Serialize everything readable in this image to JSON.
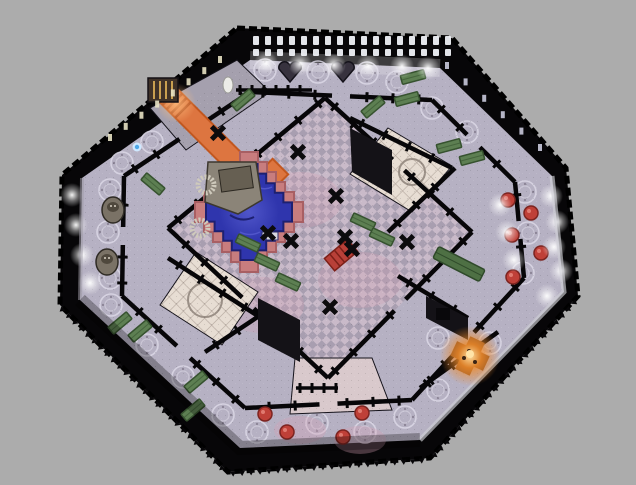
{
  "scene": {
    "viewport": {
      "width": 636,
      "height": 485
    },
    "background": "#acacac",
    "colors": {
      "wall": "#070608",
      "corridor_floor": "#b6b1c3",
      "hall_tile_light": "#c9bac9",
      "hall_tile_dark": "#a89eb0",
      "room_tile_light": "#e7ddd3",
      "room_tile_line": "#b4a79e",
      "pool_blue": "#2f35ad",
      "pool_blue_dark": "#1d2070",
      "pool_ripple_light": "#575dd0",
      "pool_pink": "#c87d7e",
      "pool_pink_dark": "#a85f63",
      "carpet_orange": "#dd7540",
      "carpet_orange_dark": "#b04818",
      "carpet_glow": "#f09a50",
      "bench_green": "#5d7f52",
      "bench_green_dark": "#36522f",
      "table_red": "#bf4038",
      "table_red_dark": "#7c2420",
      "window_white": "#eef0f6",
      "window_yellow": "#e8e2c4",
      "window_dim": "#c9c9dc",
      "fire_glow": "#f08a28",
      "fire_core": "#ffe4a8",
      "stone": "#8b8478",
      "stone_dark": "#665f52",
      "statue": "#7a7266",
      "statue_dark": "#37323e",
      "rim_light": "#d0cfd6",
      "flower_line": "#dcd8e6",
      "altar_wood": "#3f3228",
      "altar_gold": "#c9a050",
      "rug_red": "#b84038"
    },
    "outer_octagon": [
      [
        237,
        28
      ],
      [
        452,
        38
      ],
      [
        566,
        168
      ],
      [
        578,
        296
      ],
      [
        430,
        458
      ],
      [
        228,
        472
      ],
      [
        60,
        305
      ],
      [
        62,
        175
      ]
    ],
    "floor_octagon": [
      [
        250,
        60
      ],
      [
        440,
        68
      ],
      [
        552,
        176
      ],
      [
        564,
        292
      ],
      [
        420,
        440
      ],
      [
        240,
        448
      ],
      [
        80,
        300
      ],
      [
        82,
        178
      ]
    ],
    "inner_wall_octagon": [
      [
        250,
        92
      ],
      [
        432,
        100
      ],
      [
        515,
        182
      ],
      [
        524,
        278
      ],
      [
        412,
        400
      ],
      [
        245,
        408
      ],
      [
        122,
        296
      ],
      [
        124,
        176
      ]
    ],
    "hall_diamond": [
      [
        325,
        98
      ],
      [
        472,
        232
      ],
      [
        328,
        378
      ],
      [
        168,
        228
      ]
    ],
    "rim_highlights": [
      {
        "points": [
          [
            552,
            176
          ],
          [
            564,
            292
          ],
          [
            420,
            440
          ]
        ],
        "w": 5,
        "color": "#d0cfd6",
        "op": 0.65
      },
      {
        "points": [
          [
            82,
            178
          ],
          [
            80,
            300
          ]
        ],
        "w": 4,
        "color": "#9a98a2",
        "op": 0.55
      }
    ],
    "shade_bottom": {
      "points": [
        [
          80,
          300
        ],
        [
          240,
          448
        ],
        [
          420,
          440
        ]
      ],
      "w": 14,
      "op": 0.28
    },
    "wash_top": {
      "points": [
        [
          250,
          60
        ],
        [
          440,
          68
        ]
      ],
      "w": 18,
      "op": 0.22
    },
    "rooms": [
      {
        "name": "room-top-left-altar",
        "points": [
          [
            150,
            108
          ],
          [
            237,
            60
          ],
          [
            270,
            92
          ],
          [
            186,
            150
          ]
        ],
        "fill": "#a5a0ae"
      },
      {
        "name": "room-top-right-tiled",
        "points": [
          [
            388,
            128
          ],
          [
            452,
            166
          ],
          [
            412,
            212
          ],
          [
            350,
            174
          ]
        ],
        "fill": "pattern:tile"
      },
      {
        "name": "room-left-tiled",
        "points": [
          [
            196,
            252
          ],
          [
            258,
            292
          ],
          [
            222,
            345
          ],
          [
            160,
            305
          ]
        ],
        "fill": "pattern:tile"
      },
      {
        "name": "room-bottom-center",
        "points": [
          [
            295,
            358
          ],
          [
            372,
            358
          ],
          [
            392,
            410
          ],
          [
            290,
            414
          ]
        ],
        "fill": "#d9c9cc"
      }
    ],
    "dark_rooms": [
      {
        "points": [
          [
            350,
            128
          ],
          [
            392,
            150
          ],
          [
            392,
            195
          ],
          [
            352,
            172
          ]
        ]
      },
      {
        "points": [
          [
            258,
            298
          ],
          [
            300,
            320
          ],
          [
            300,
            362
          ],
          [
            258,
            340
          ]
        ]
      },
      {
        "points": [
          [
            426,
            296
          ],
          [
            468,
            318
          ],
          [
            468,
            340
          ],
          [
            426,
            318
          ]
        ]
      }
    ],
    "walls": [
      {
        "a": [
          350,
          118
        ],
        "b": [
          452,
          168
        ]
      },
      {
        "a": [
          388,
          232
        ],
        "b": [
          455,
          168
        ]
      },
      {
        "a": [
          168,
          258
        ],
        "b": [
          258,
          316
        ]
      },
      {
        "a": [
          205,
          352
        ],
        "b": [
          262,
          314
        ]
      },
      {
        "a": [
          398,
          276
        ],
        "b": [
          468,
          318
        ]
      },
      {
        "a": [
          420,
          388
        ],
        "b": [
          498,
          332
        ]
      }
    ],
    "railings": [
      {
        "a": [
          236,
          90
        ],
        "b": [
          312,
          90
        ]
      },
      {
        "a": [
          296,
          388
        ],
        "b": [
          338,
          388
        ]
      }
    ],
    "teeth_edges": [
      {
        "a": [
          60,
          305
        ],
        "b": [
          228,
          472
        ]
      },
      {
        "a": [
          228,
          472
        ],
        "b": [
          430,
          458
        ]
      },
      {
        "a": [
          430,
          458
        ],
        "b": [
          578,
          296
        ]
      }
    ],
    "flower_circles": [
      [
        265,
        70
      ],
      [
        318,
        72
      ],
      [
        367,
        73
      ],
      [
        207,
        97
      ],
      [
        152,
        142
      ],
      [
        122,
        163
      ],
      [
        110,
        190
      ],
      [
        108,
        232
      ],
      [
        110,
        278
      ],
      [
        111,
        305
      ],
      [
        147,
        345
      ],
      [
        183,
        377
      ],
      [
        223,
        415
      ],
      [
        257,
        432
      ],
      [
        317,
        423
      ],
      [
        365,
        432
      ],
      [
        405,
        417
      ],
      [
        523,
        273
      ],
      [
        528,
        233
      ],
      [
        525,
        192
      ],
      [
        467,
        132
      ],
      [
        432,
        108
      ],
      [
        397,
        82
      ],
      [
        490,
        343
      ],
      [
        438,
        338
      ],
      [
        438,
        390
      ],
      [
        412,
        172
      ],
      [
        205,
        300
      ]
    ],
    "pink_patches": [
      [
        300,
        200
      ],
      [
        360,
        280
      ],
      [
        262,
        305
      ],
      [
        300,
        430
      ],
      [
        360,
        440
      ]
    ],
    "lights": [
      [
        72,
        195
      ],
      [
        76,
        225
      ],
      [
        82,
        255
      ],
      [
        90,
        283
      ],
      [
        551,
        196
      ],
      [
        557,
        222
      ],
      [
        554,
        247
      ],
      [
        561,
        271
      ],
      [
        547,
        296
      ],
      [
        500,
        205
      ],
      [
        507,
        232
      ],
      [
        514,
        260
      ],
      [
        266,
        63
      ],
      [
        300,
        64
      ],
      [
        334,
        65
      ],
      [
        368,
        66
      ],
      [
        402,
        66
      ],
      [
        428,
        68
      ]
    ],
    "windows_top": {
      "x_start": 253,
      "x_end": 445,
      "step": 12,
      "rows": [
        {
          "y": 36,
          "h": 9,
          "w": 6
        },
        {
          "y": 49,
          "h": 7,
          "w": 6
        }
      ]
    },
    "windows_top_left": {
      "from": [
        108,
        134
      ],
      "to": [
        218,
        56
      ],
      "count": 8,
      "w": 4,
      "h": 7
    },
    "windows_top_right": {
      "from": [
        445,
        62
      ],
      "to": [
        538,
        144
      ],
      "count": 6,
      "w": 4,
      "h": 7
    },
    "benches": [
      {
        "x": 413,
        "y": 77,
        "r": -15
      },
      {
        "x": 407,
        "y": 99,
        "r": -15
      },
      {
        "x": 449,
        "y": 146,
        "r": -15
      },
      {
        "x": 472,
        "y": 158,
        "r": -15
      },
      {
        "x": 373,
        "y": 107,
        "r": -40
      },
      {
        "x": 243,
        "y": 100,
        "r": -40
      },
      {
        "x": 153,
        "y": 184,
        "r": 40
      },
      {
        "x": 248,
        "y": 243,
        "r": 25
      },
      {
        "x": 267,
        "y": 262,
        "r": 25
      },
      {
        "x": 288,
        "y": 282,
        "r": 25
      },
      {
        "x": 363,
        "y": 222,
        "r": 25
      },
      {
        "x": 382,
        "y": 237,
        "r": 25
      },
      {
        "x": 120,
        "y": 323,
        "r": -40
      },
      {
        "x": 140,
        "y": 331,
        "r": -40
      },
      {
        "x": 196,
        "y": 382,
        "r": -40
      },
      {
        "x": 193,
        "y": 410,
        "r": -40
      }
    ],
    "long_table": {
      "x": 459,
      "y": 264,
      "len": 52,
      "w": 13,
      "r": 27
    },
    "crosses": [
      [
        298,
        152
      ],
      [
        336,
        196
      ],
      [
        268,
        233
      ],
      [
        291,
        241
      ],
      [
        345,
        237
      ],
      [
        352,
        249
      ],
      [
        407,
        242
      ],
      [
        330,
        307
      ],
      [
        218,
        133
      ]
    ],
    "red_tables": [
      [
        508,
        200
      ],
      [
        531,
        213
      ],
      [
        512,
        235
      ],
      [
        541,
        253
      ],
      [
        513,
        277
      ],
      [
        265,
        414
      ],
      [
        287,
        432
      ],
      [
        362,
        413
      ],
      [
        343,
        437
      ]
    ],
    "statues_owl": [
      [
        113,
        210
      ],
      [
        107,
        262
      ]
    ],
    "statues_heart": [
      [
        290,
        73
      ],
      [
        343,
        73
      ]
    ],
    "white_statue": [
      228,
      85
    ],
    "npc_blue": [
      137,
      147
    ],
    "altar": {
      "x": 148,
      "y": 78,
      "w": 30,
      "h": 24
    },
    "carpet": {
      "main": {
        "cx": 207,
        "cy": 134,
        "len": 118,
        "w": 22,
        "rot": 45
      },
      "pad": {
        "cx": 262,
        "cy": 185,
        "len": 52,
        "w": 22,
        "rot": -45
      },
      "glow": [
        176,
        103
      ]
    },
    "red_rug": {
      "x": 341,
      "y": 255,
      "w": 30,
      "h": 16,
      "rot": -40
    },
    "pool": {
      "cx": 249,
      "cy": 212,
      "r_pink_x": 54,
      "r_pink_y": 60,
      "r_blue_x": 43,
      "r_blue_y": 48,
      "step": 9
    },
    "pool_sign": {
      "x": 262,
      "y": 232,
      "w": 16,
      "h": 8
    },
    "platform": {
      "points": [
        [
          208,
          162
        ],
        [
          256,
          162
        ],
        [
          262,
          200
        ],
        [
          238,
          214
        ],
        [
          205,
          202
        ]
      ]
    },
    "stairs": [
      [
        206,
        185
      ],
      [
        200,
        228
      ]
    ],
    "fire": {
      "x": 470,
      "y": 356,
      "r": 30
    }
  }
}
